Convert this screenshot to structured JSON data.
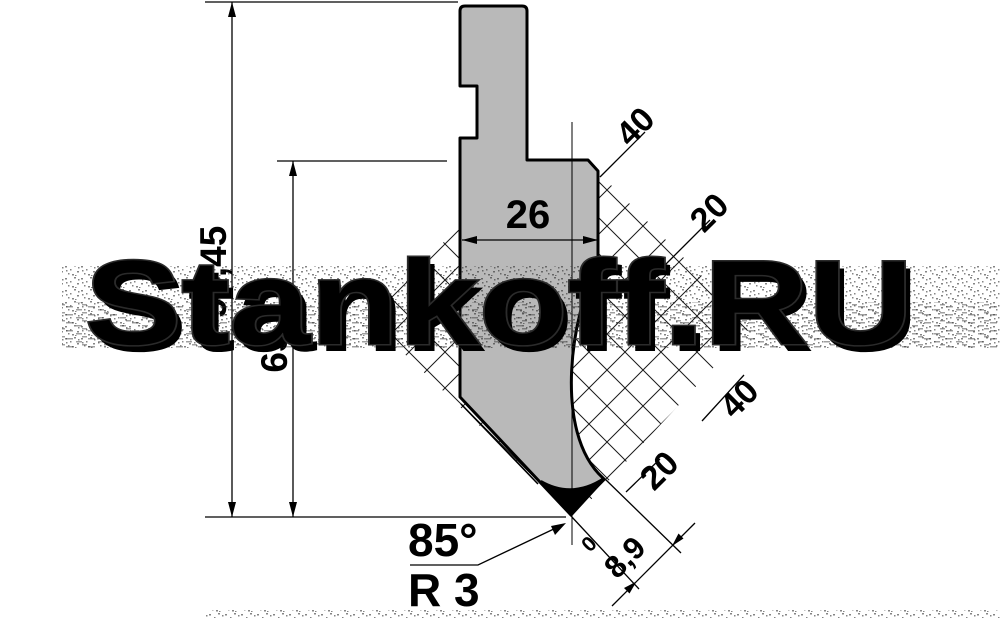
{
  "drawing": {
    "type": "press-brake punch profile drawing",
    "watermark": {
      "text": "Stankoff.RU"
    },
    "dims": {
      "total_height": "95,45",
      "working_height": "65",
      "body_width": "26",
      "tip_angle": "85°",
      "tip_radius": "R 3",
      "tip_zero": "0",
      "tip_offset": "8,9"
    },
    "grid": {
      "top_labels": [
        "40",
        "20"
      ],
      "bottom_labels": [
        "40",
        "20"
      ]
    },
    "colors": {
      "body_fill": "#b9b9b9",
      "outline": "#000000",
      "watermark_fill": "#ffffff",
      "watermark_shadow": "#1b1b1b"
    }
  }
}
